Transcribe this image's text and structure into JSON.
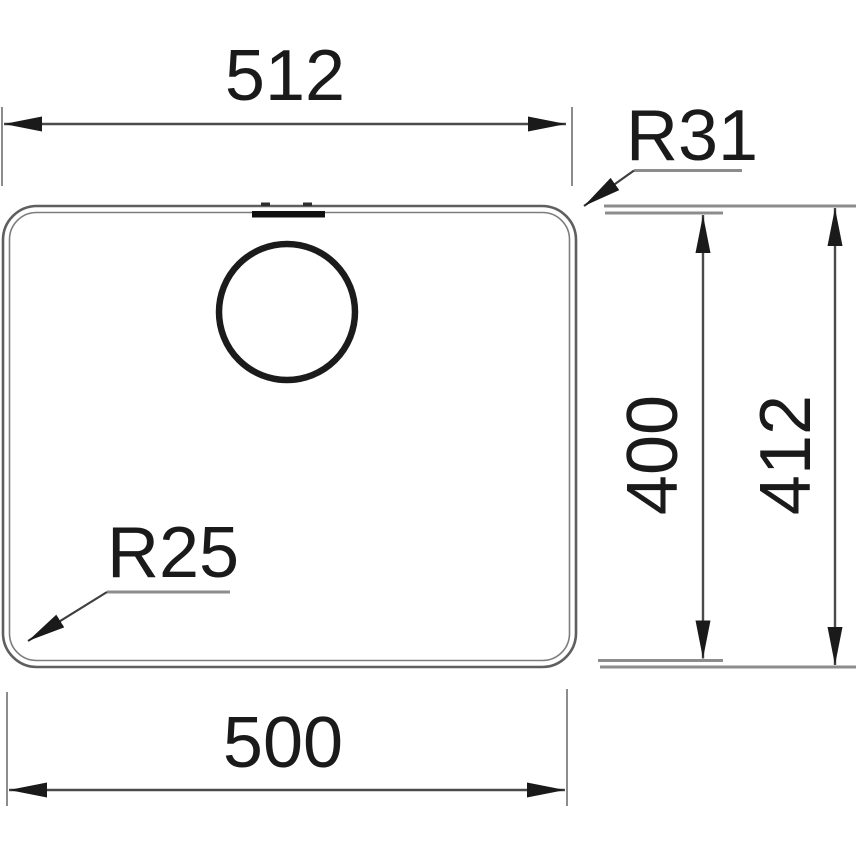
{
  "diagram": {
    "labels": {
      "top_width": "512",
      "top_right_radius": "R31",
      "inner_height": "400",
      "outer_height": "412",
      "bottom_left_radius": "R25",
      "bottom_width": "500"
    },
    "colors": {
      "background": "#ffffff",
      "outline_outer": "#5f5f5f",
      "outline_inner": "#7d7d7d",
      "dimension_line": "#4a4a4a",
      "extension_line": "#8c8c8c",
      "leader_line": "#3f3f3f",
      "leader_shelf": "#8c8c8c",
      "arrow": "#1a1a1a",
      "text": "#1a1a1a",
      "drain_ring": "#1b1b1b",
      "overflow_slot": "#101010",
      "overflow_tick": "#2e2e2e"
    }
  }
}
